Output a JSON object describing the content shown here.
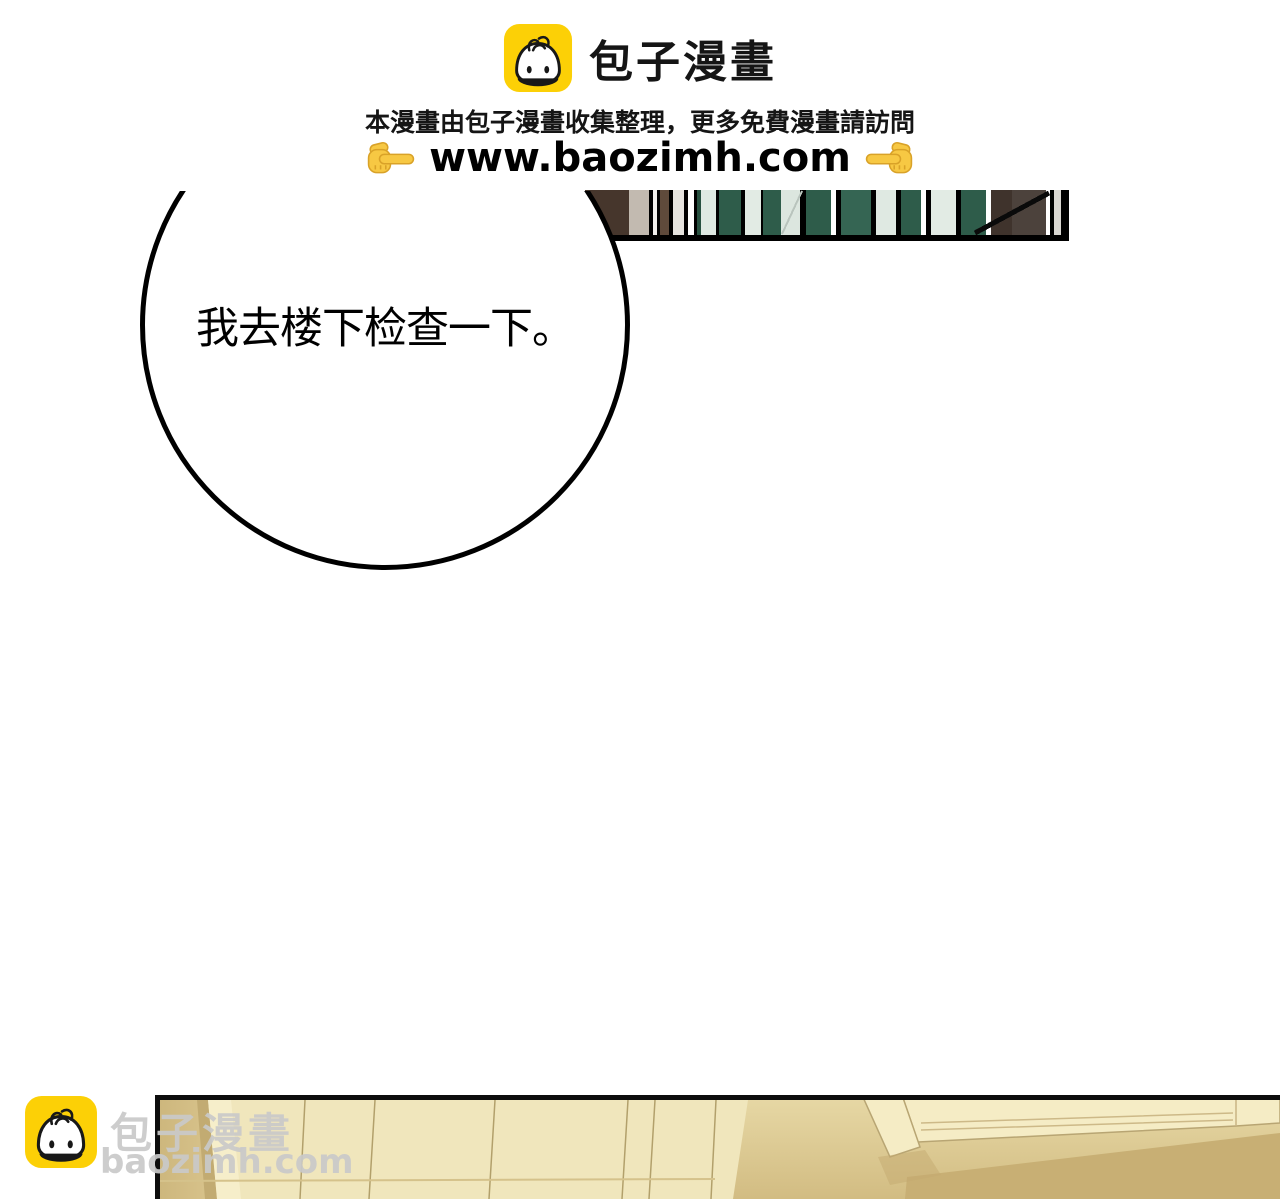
{
  "header": {
    "brand_name": "包子漫畫",
    "tagline": "本漫畫由包子漫畫收集整理，更多免費漫畫請訪問",
    "url": "www.baozimh.com",
    "brand_yellow": "#fcd006",
    "hand_yellow": "#f7c843"
  },
  "speech_bubble": {
    "text": "我去楼下检查一下。"
  },
  "panels": {
    "bookshelf_strip": {
      "green": "#2e5c4a",
      "green_light": "#356553",
      "pale": "#e0eae3",
      "brown": "#5f4a3b",
      "dark_brown": "#46362c",
      "gray_brown": "#4c423c"
    },
    "cabinet_scene": {
      "cream": "#f0e6bc",
      "tan": "#d6c28c",
      "dark_tan": "#c8af74"
    }
  },
  "watermark": {
    "brand_name": "包子漫畫",
    "url": "baozimh.com",
    "gray": "#c9c9c9"
  }
}
